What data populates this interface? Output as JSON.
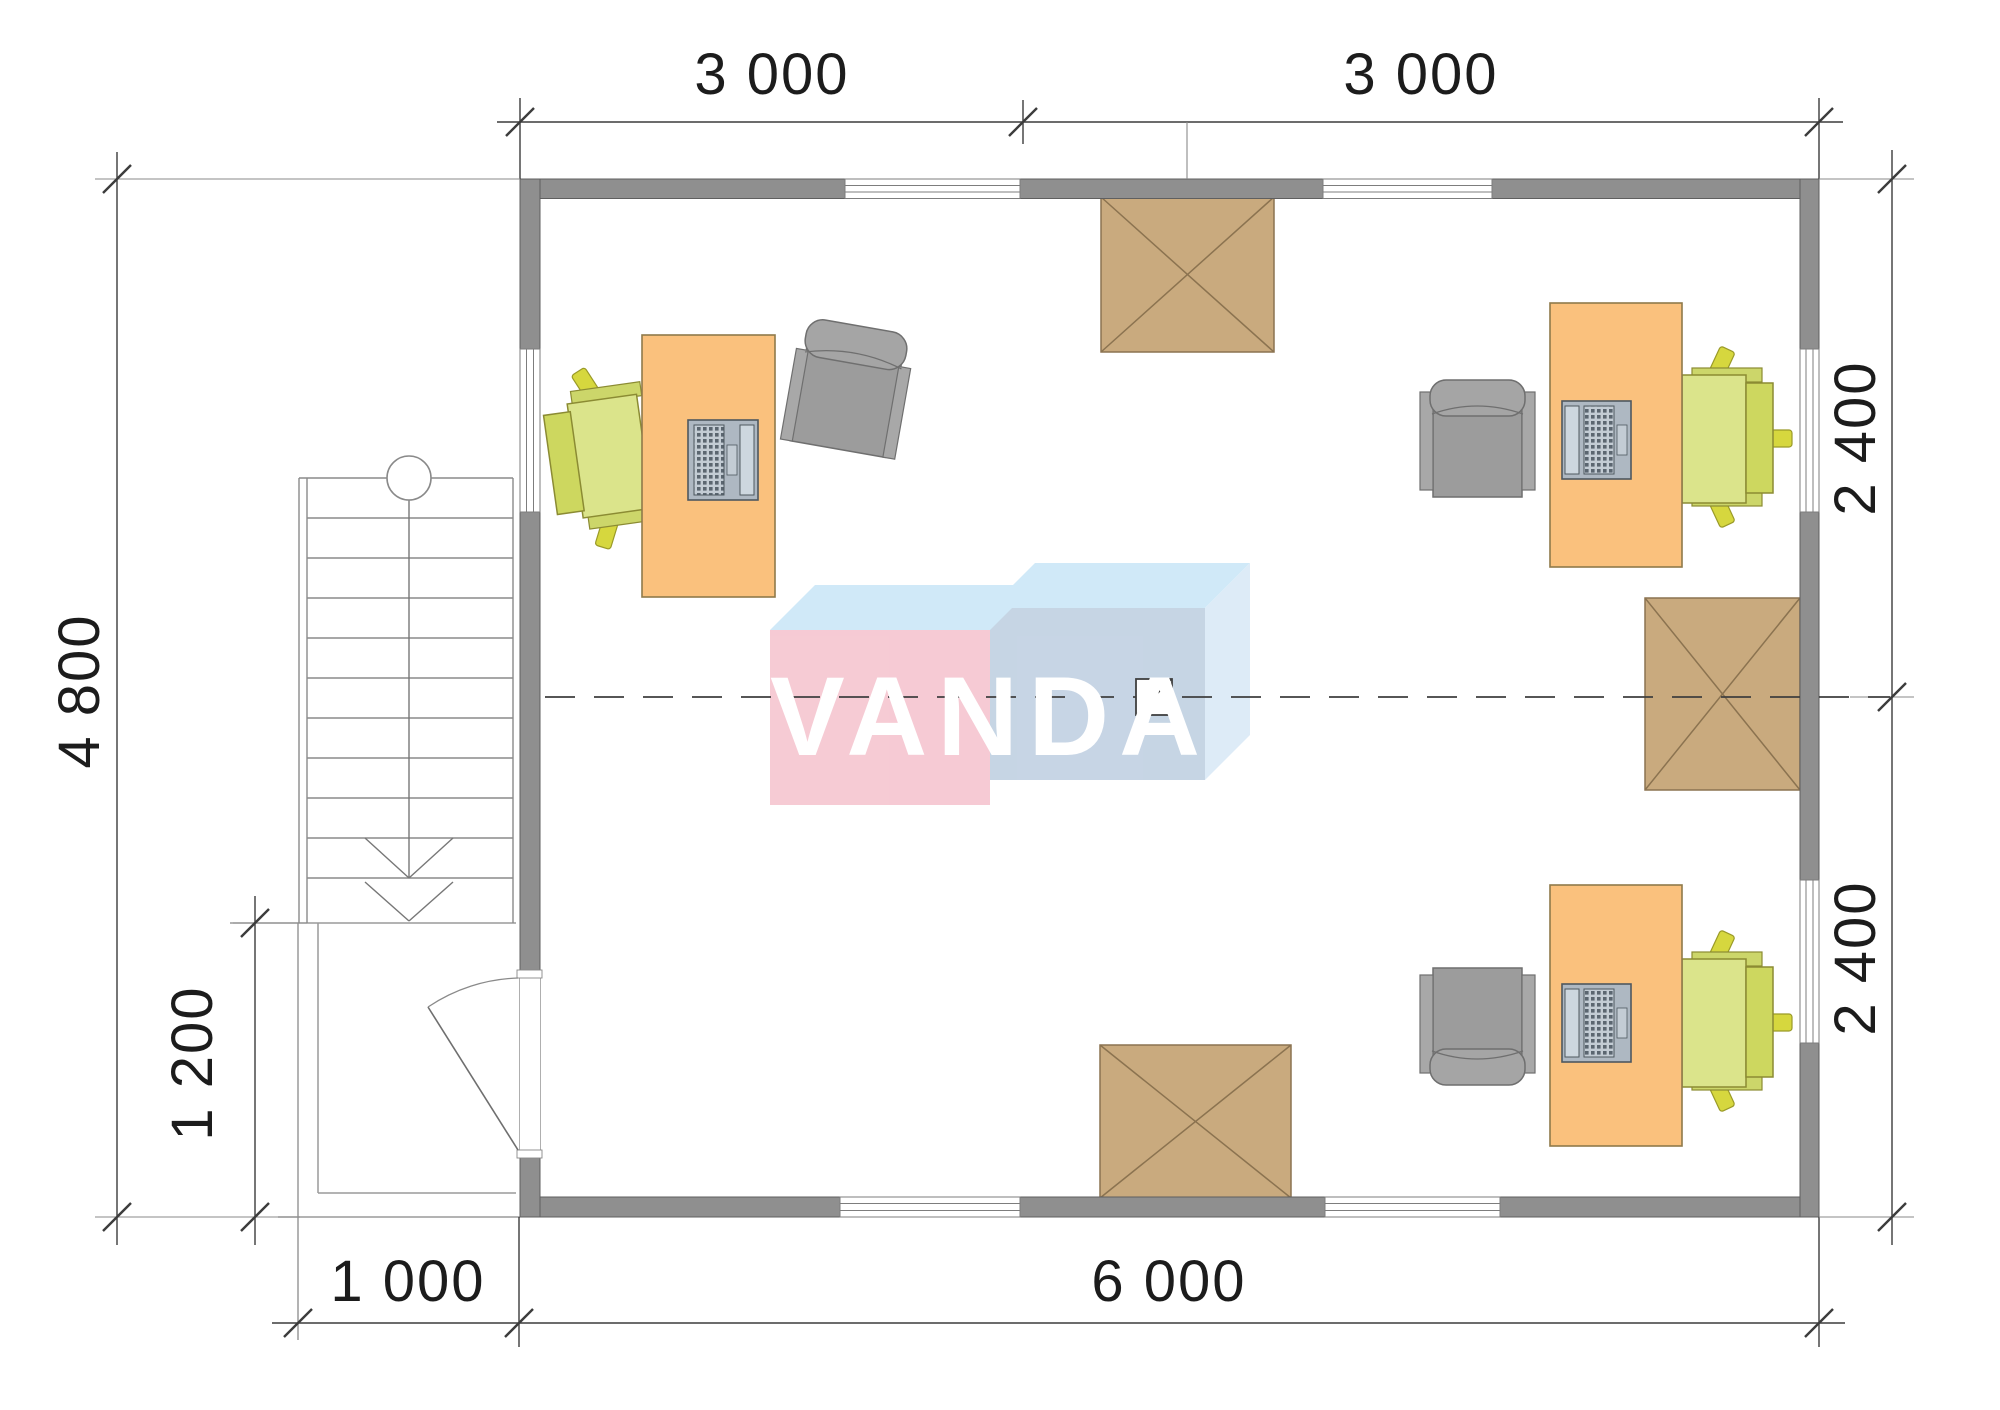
{
  "page": {
    "type": "architectural-floor-plan",
    "background": "#ffffff"
  },
  "logo": {
    "text": "VANDA",
    "text_color": "#ffffff",
    "front_box_color": "#f6c9d3",
    "right_box_color": "#c5d4e4",
    "top_face_color": "#cfe9f8",
    "side_face_color": "#dcebf7"
  },
  "dimensions": {
    "top": [
      "3 000",
      "3 000"
    ],
    "bottom": [
      "1 000",
      "6 000"
    ],
    "left": [
      "4 800",
      "1 200"
    ],
    "right": [
      "2 400",
      "2 400"
    ]
  },
  "colors": {
    "wall": "#8f8f8f",
    "wall_edge": "#5f5f5f",
    "dimension_line": "#333333",
    "construction_line": "#9a9a9a",
    "desk": "#fac17d",
    "desk_edge": "#8f7a4a",
    "task_chair": "#d9e383",
    "task_chair_edge": "#8b8b33",
    "armchair": "#9c9c9c",
    "armchair_edge": "#6f6f6f",
    "hatch_box": "#c9aa7e",
    "hatch_box_edge": "#8b7350",
    "laptop": "#b5bfc9"
  },
  "symbols": [
    {
      "name": "stair-flight",
      "note": "stairs with up-arrow and newel circle"
    },
    {
      "name": "entry-door-swing",
      "note": "door leaf with quarter-circle swing"
    },
    {
      "name": "window-symbol",
      "count": 7
    },
    {
      "name": "hatch-box-symbol",
      "count": 3
    },
    {
      "name": "desk-with-laptop",
      "count": 3
    },
    {
      "name": "task-chair",
      "count": 3
    },
    {
      "name": "armchair",
      "count": 3
    },
    {
      "name": "center-axis-marker",
      "note": "small square with diagonal on dashed axis"
    }
  ]
}
